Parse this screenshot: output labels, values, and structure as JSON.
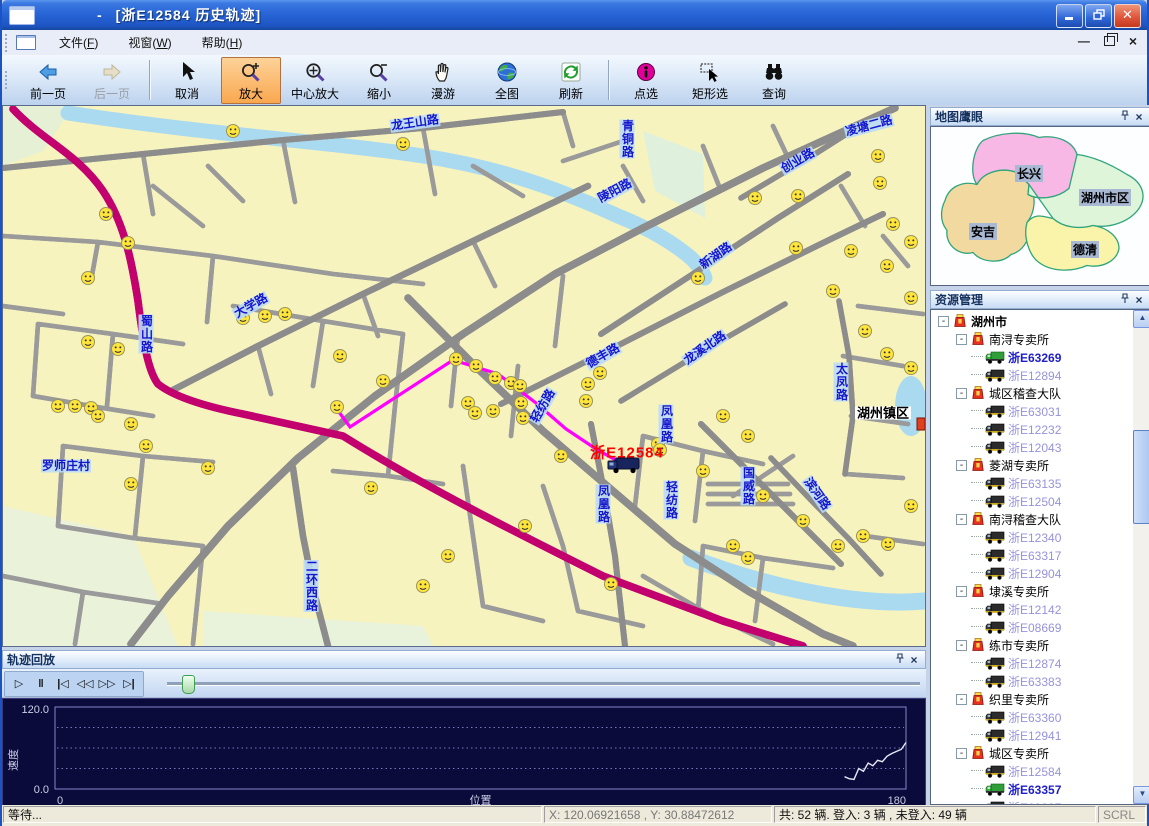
{
  "window": {
    "title_dash": "-",
    "title": "[浙E12584  历史轨迹]"
  },
  "menubar": {
    "items": [
      "文件(F)",
      "视窗(W)",
      "帮助(H)"
    ]
  },
  "toolbar": {
    "buttons": [
      {
        "name": "prev-page",
        "label": "前一页",
        "icon": "arrow-left-icon",
        "state": "normal"
      },
      {
        "name": "next-page",
        "label": "后一页",
        "icon": "arrow-right-icon",
        "state": "disabled"
      },
      {
        "type": "separator"
      },
      {
        "name": "cancel",
        "label": "取消",
        "icon": "cursor-icon",
        "state": "normal"
      },
      {
        "name": "zoom-in",
        "label": "放大",
        "icon": "zoom-in-icon",
        "state": "active"
      },
      {
        "name": "center-zoom",
        "label": "中心放大",
        "icon": "zoom-center-icon",
        "state": "normal"
      },
      {
        "name": "zoom-out",
        "label": "缩小",
        "icon": "zoom-out-icon",
        "state": "normal"
      },
      {
        "name": "pan",
        "label": "漫游",
        "icon": "pan-hand-icon",
        "state": "normal"
      },
      {
        "name": "full-map",
        "label": "全图",
        "icon": "globe-icon",
        "state": "normal"
      },
      {
        "name": "refresh",
        "label": "刷新",
        "icon": "refresh-icon",
        "state": "normal"
      },
      {
        "type": "separator"
      },
      {
        "name": "point-select",
        "label": "点选",
        "icon": "info-select-icon",
        "state": "normal"
      },
      {
        "name": "rect-select",
        "label": "矩形选",
        "icon": "rect-select-icon",
        "state": "normal"
      },
      {
        "name": "query",
        "label": "查询",
        "icon": "binoculars-icon",
        "state": "normal"
      }
    ]
  },
  "map": {
    "vehicle": {
      "plate": "浙E12584",
      "x": 604,
      "y": 350,
      "label_x": 624,
      "label_y": 347
    },
    "track_color": "#FF00FF",
    "track": [
      [
        333,
        302
      ],
      [
        347,
        321
      ],
      [
        450,
        254
      ],
      [
        495,
        268
      ],
      [
        533,
        297
      ],
      [
        563,
        323
      ],
      [
        593,
        343
      ],
      [
        618,
        357
      ]
    ],
    "labels": [
      {
        "text": "龙王山路",
        "x": 412,
        "y": 17,
        "rot": -8
      },
      {
        "text": "青铜路",
        "x": 624,
        "y": 33,
        "vertical": true
      },
      {
        "text": "陵阳路",
        "x": 612,
        "y": 85,
        "rot": -28
      },
      {
        "text": "创业路",
        "x": 795,
        "y": 55,
        "rot": -30
      },
      {
        "text": "凌塘二路",
        "x": 866,
        "y": 20,
        "rot": -15
      },
      {
        "text": "新湖路",
        "x": 713,
        "y": 150,
        "rot": -35
      },
      {
        "text": "大学路",
        "x": 248,
        "y": 200,
        "rot": -30
      },
      {
        "text": "蜀山路",
        "x": 143,
        "y": 228,
        "vertical": true
      },
      {
        "text": "德丰路",
        "x": 600,
        "y": 250,
        "rot": -30
      },
      {
        "text": "龙溪北路",
        "x": 702,
        "y": 242,
        "rot": -35
      },
      {
        "text": "轻纺路",
        "x": 540,
        "y": 300,
        "rot": -60
      },
      {
        "text": "轻纺路",
        "x": 668,
        "y": 394,
        "vertical": true
      },
      {
        "text": "凤凰路",
        "x": 600,
        "y": 398,
        "vertical": true
      },
      {
        "text": "凤凰路",
        "x": 663,
        "y": 318,
        "vertical": true
      },
      {
        "text": "国威路",
        "x": 745,
        "y": 380,
        "vertical": true
      },
      {
        "text": "太凤路",
        "x": 838,
        "y": 276,
        "vertical": true
      },
      {
        "text": "滨河路",
        "x": 814,
        "y": 388,
        "rot": 55
      },
      {
        "text": "二环西路",
        "x": 308,
        "y": 480,
        "vertical": true
      },
      {
        "text": "罗师庄村",
        "x": 63,
        "y": 360,
        "rot": 0
      },
      {
        "text": "湖州镇区",
        "x": 880,
        "y": 307,
        "rot": 0,
        "style": "place"
      }
    ],
    "smileys": [
      [
        230,
        25
      ],
      [
        400,
        38
      ],
      [
        103,
        108
      ],
      [
        125,
        137
      ],
      [
        85,
        172
      ],
      [
        282,
        208
      ],
      [
        337,
        250
      ],
      [
        380,
        275
      ],
      [
        334,
        301
      ],
      [
        752,
        92
      ],
      [
        795,
        90
      ],
      [
        875,
        50
      ],
      [
        877,
        77
      ],
      [
        890,
        118
      ],
      [
        848,
        145
      ],
      [
        884,
        160
      ],
      [
        908,
        136
      ],
      [
        830,
        185
      ],
      [
        793,
        142
      ],
      [
        695,
        172
      ],
      [
        908,
        192
      ],
      [
        862,
        225
      ],
      [
        884,
        248
      ],
      [
        908,
        262
      ],
      [
        453,
        253
      ],
      [
        473,
        260
      ],
      [
        492,
        272
      ],
      [
        508,
        277
      ],
      [
        517,
        280
      ],
      [
        465,
        297
      ],
      [
        472,
        307
      ],
      [
        490,
        305
      ],
      [
        518,
        297
      ],
      [
        520,
        312
      ],
      [
        585,
        278
      ],
      [
        583,
        295
      ],
      [
        597,
        267
      ],
      [
        558,
        350
      ],
      [
        655,
        338
      ],
      [
        657,
        344
      ],
      [
        368,
        382
      ],
      [
        720,
        310
      ],
      [
        745,
        330
      ],
      [
        700,
        365
      ],
      [
        760,
        390
      ],
      [
        800,
        415
      ],
      [
        835,
        440
      ],
      [
        860,
        430
      ],
      [
        885,
        438
      ],
      [
        908,
        400
      ],
      [
        420,
        480
      ],
      [
        445,
        450
      ],
      [
        522,
        420
      ],
      [
        730,
        440
      ],
      [
        745,
        452
      ],
      [
        608,
        478
      ],
      [
        85,
        236
      ],
      [
        115,
        243
      ],
      [
        55,
        300
      ],
      [
        72,
        300
      ],
      [
        88,
        302
      ],
      [
        95,
        310
      ],
      [
        128,
        318
      ],
      [
        143,
        340
      ],
      [
        128,
        378
      ],
      [
        205,
        362
      ],
      [
        262,
        210
      ],
      [
        240,
        212
      ]
    ]
  },
  "overview": {
    "title": "地图鹰眼",
    "regions": [
      {
        "name": "长兴",
        "color": "#F7B8E6"
      },
      {
        "name": "湖州市区",
        "color": "#DFF5DA"
      },
      {
        "name": "安吉",
        "color": "#F2D9A0"
      },
      {
        "name": "德清",
        "color": "#FAF3AA"
      }
    ]
  },
  "resources": {
    "title": "资源管理",
    "root": "湖州市",
    "groups": [
      {
        "name": "南浔专卖所",
        "vehicles": [
          {
            "plate": "浙E63269",
            "online": true
          },
          {
            "plate": "浙E12894",
            "online": false
          }
        ]
      },
      {
        "name": "城区稽查大队",
        "vehicles": [
          {
            "plate": "浙E63031",
            "online": false
          },
          {
            "plate": "浙E12232",
            "online": false
          },
          {
            "plate": "浙E12043",
            "online": false
          }
        ]
      },
      {
        "name": "菱湖专卖所",
        "vehicles": [
          {
            "plate": "浙E63135",
            "online": false
          },
          {
            "plate": "浙E12504",
            "online": false
          }
        ]
      },
      {
        "name": "南浔稽查大队",
        "vehicles": [
          {
            "plate": "浙E12340",
            "online": false
          },
          {
            "plate": "浙E63317",
            "online": false
          },
          {
            "plate": "浙E12904",
            "online": false
          }
        ]
      },
      {
        "name": "埭溪专卖所",
        "vehicles": [
          {
            "plate": "浙E12142",
            "online": false
          },
          {
            "plate": "浙E08669",
            "online": false
          }
        ]
      },
      {
        "name": "练市专卖所",
        "vehicles": [
          {
            "plate": "浙E12874",
            "online": false
          },
          {
            "plate": "浙E63383",
            "online": false
          }
        ]
      },
      {
        "name": "织里专卖所",
        "vehicles": [
          {
            "plate": "浙E63360",
            "online": false
          },
          {
            "plate": "浙E12941",
            "online": false
          }
        ]
      },
      {
        "name": "城区专卖所",
        "vehicles": [
          {
            "plate": "浙E12584",
            "online": false
          },
          {
            "plate": "浙E63357",
            "online": true
          },
          {
            "plate": "浙E09387",
            "online": false
          }
        ]
      }
    ]
  },
  "playback": {
    "title": "轨迹回放",
    "buttons": [
      {
        "name": "play",
        "glyph": "▷"
      },
      {
        "name": "pause",
        "glyph": "‖"
      },
      {
        "name": "skip-start",
        "glyph": "|◁"
      },
      {
        "name": "rewind",
        "glyph": "◁◁"
      },
      {
        "name": "fast-forward",
        "glyph": "▷▷"
      },
      {
        "name": "skip-end",
        "glyph": "▷|"
      }
    ],
    "slider_pos": 0.02
  },
  "chart_data": {
    "type": "line",
    "xlabel": "位置",
    "ylabel": "速度",
    "xlim": [
      0,
      180
    ],
    "ylim": [
      0.0,
      120.0
    ],
    "xticks": [
      "0",
      "180"
    ],
    "yticks": [
      "0.0",
      "120.0"
    ],
    "grid": "horizontal-dotted",
    "bg": "#0B0B3B",
    "line_color": "#E8E8F8",
    "series": [
      {
        "name": "速度",
        "x": [
          167,
          168,
          169,
          170,
          171,
          172,
          173,
          174,
          175,
          176,
          177,
          178,
          179,
          180
        ],
        "y": [
          18,
          15,
          14,
          30,
          26,
          38,
          34,
          42,
          40,
          48,
          52,
          55,
          58,
          68
        ]
      }
    ]
  },
  "statusbar": {
    "sections": [
      {
        "text": "等待..."
      },
      {
        "text": "X: 120.06921658 , Y: 30.88472612"
      },
      {
        "text": "共: 52 辆. 登入: 3 辆 , 未登入: 49 辆"
      },
      {
        "text": "SCRL"
      }
    ]
  }
}
